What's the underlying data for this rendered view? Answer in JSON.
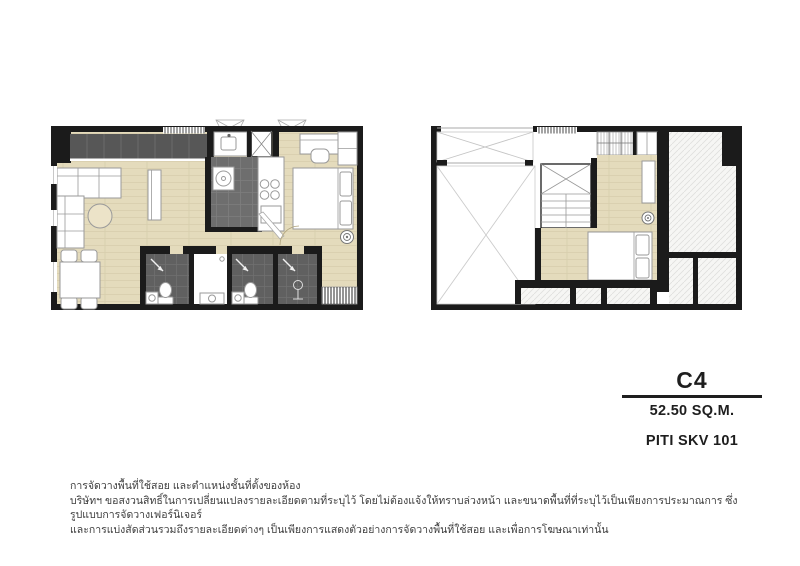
{
  "unit": {
    "name": "C4",
    "area": "52.50 SQ.M.",
    "project": "PITI SKV 101"
  },
  "plans": {
    "lower": {
      "name": "lower-floor-plan"
    },
    "upper": {
      "name": "upper-floor-plan"
    }
  },
  "disclaimer": {
    "lines": [
      "การจัดวางพื้นที่ใช้สอย และตำแหน่งชั้นที่ตั้งของห้อง",
      "บริษัทฯ ขอสงวนสิทธิ์ในการเปลี่ยนแปลงรายละเอียดตามที่ระบุไว้ โดยไม่ต้องแจ้งให้ทราบล่วงหน้า และขนาดพื้นที่ที่ระบุไว้เป็นเพียงการประมาณการ ซึ่งรูปแบบการจัดวางเฟอร์นิเจอร์",
      "และการแบ่งสัดส่วนรวมถึงรายละเอียดต่างๆ เป็นเพียงการแสดงตัวอย่างการจัดวางพื้นที่ใช้สอย และเพื่อการโฆษณาเท่านั้น"
    ]
  },
  "colors": {
    "bg": "#ffffff",
    "wall": "#1b1b1b",
    "floor": "#e4dbbc",
    "plank": "#d2c8a6",
    "counter": "#575757",
    "kitchen": "#6e6e6e",
    "bath": "#606060",
    "fixture": "#9a9a9a",
    "hatchbg": "#f6f6f4",
    "hatchline": "#e0e0de",
    "text": "#1e1e1e",
    "note": "#3d3d3d"
  }
}
